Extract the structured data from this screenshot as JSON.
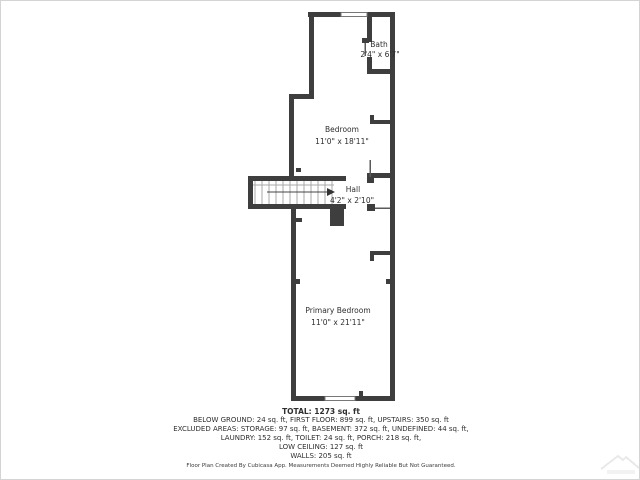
{
  "colors": {
    "wall": "#3e3e3e",
    "text": "#2e2e2e",
    "tread": "#a8a8a8",
    "door": "#5a5a5a",
    "watermark": "#e9e9e9"
  },
  "rooms": {
    "bath": {
      "name": "Bath",
      "dims": "2'4\" x 6'7\""
    },
    "bedroom": {
      "name": "Bedroom",
      "dims": "11'0\" x 18'11\""
    },
    "hall": {
      "name": "Hall",
      "dims": "4'2\" x 2'10\""
    },
    "primary_bedroom": {
      "name": "Primary Bedroom",
      "dims": "11'0\" x 21'11\""
    }
  },
  "summary": {
    "total": "TOTAL: 1273 sq. ft",
    "lines": [
      "BELOW GROUND: 24 sq. ft, FIRST FLOOR: 899 sq. ft, UPSTAIRS: 350 sq. ft",
      "EXCLUDED AREAS: STORAGE: 97 sq. ft, BASEMENT: 372 sq. ft, UNDEFINED: 44 sq. ft,",
      "LAUNDRY: 152 sq. ft, TOILET: 24 sq. ft, PORCH: 218 sq. ft,",
      "LOW CEILING: 127 sq. ft",
      "WALLS: 205 sq. ft"
    ]
  },
  "footer": {
    "disclaimer": "Floor Plan Created By Cubicasa App. Measurements Deemed Highly Reliable But Not Guaranteed."
  }
}
